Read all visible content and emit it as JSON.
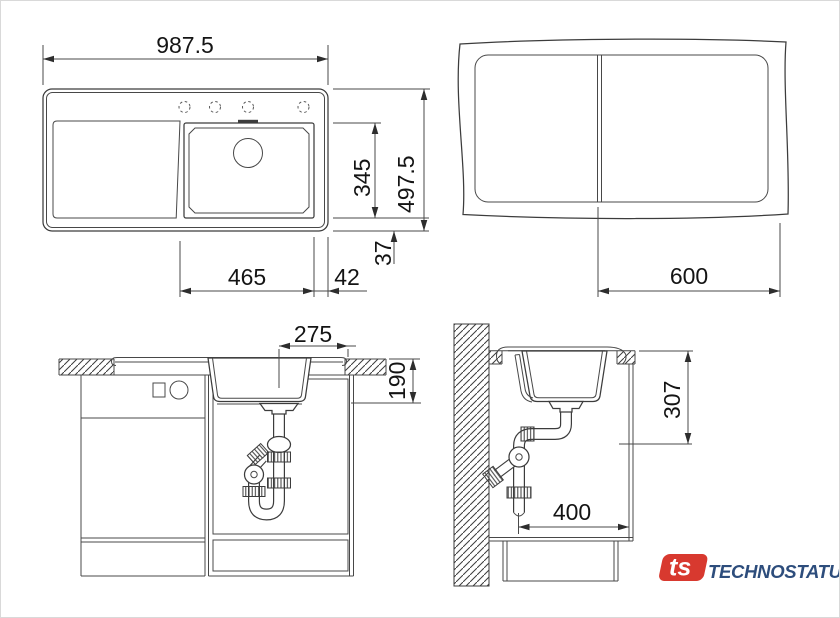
{
  "colors": {
    "background": "#ffffff",
    "line": "#3c3c3c",
    "text": "#141414",
    "logo_red": "#d8392f",
    "logo_blue": "#2d4d7c"
  },
  "top_view": {
    "overall_width": "987.5",
    "overall_depth": "497.5",
    "bowl_length": "345",
    "bowl_to_edge_bottom": "37",
    "bowl_width": "465",
    "bowl_to_edge_right": "42"
  },
  "cutout_view": {
    "centerline_to_edge": "600"
  },
  "front_view": {
    "center_to_edge": "275",
    "bowl_depth": "190"
  },
  "side_view": {
    "rim_to_drain_height": "307",
    "wall_clearance": "400"
  },
  "logo": {
    "mark": "ts",
    "name": "TECHNOSTATUS"
  }
}
